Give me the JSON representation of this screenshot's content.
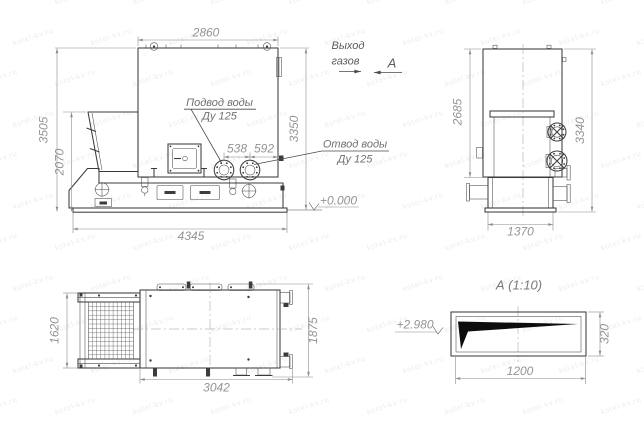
{
  "watermark": {
    "text": "kotel-kv.ru"
  },
  "colors": {
    "line": "#3c3c3c",
    "dim_text": "#949494",
    "label_text": "#6f6f6f",
    "background": "#ffffff",
    "detail_fill": "#0d0d0d"
  },
  "side_view": {
    "dims": {
      "top_width": "2860",
      "total_height": "3505",
      "hopper_height": "2070",
      "right_height": "3350",
      "flange_dim1": "538",
      "flange_dim2": "592",
      "base_length": "4345"
    },
    "labels": {
      "water_inlet": "Подвод воды",
      "water_inlet_dn": "Ду 125",
      "water_outlet": "Отвод воды",
      "water_outlet_dn": "Ду 125",
      "gas_exit_1": "Выход",
      "gas_exit_2": "газов",
      "section_letter": "А",
      "ground_elevation": "+0.000"
    }
  },
  "front_view": {
    "dims": {
      "body_height": "2685",
      "total_height": "3340",
      "base_width": "1370"
    }
  },
  "top_view": {
    "dims": {
      "hopper_span": "1620",
      "depth": "1875",
      "length": "3042"
    }
  },
  "detail_view": {
    "title": "А (1:10)",
    "elevation": "+2.980",
    "dims": {
      "width": "1200",
      "height": "320"
    }
  }
}
